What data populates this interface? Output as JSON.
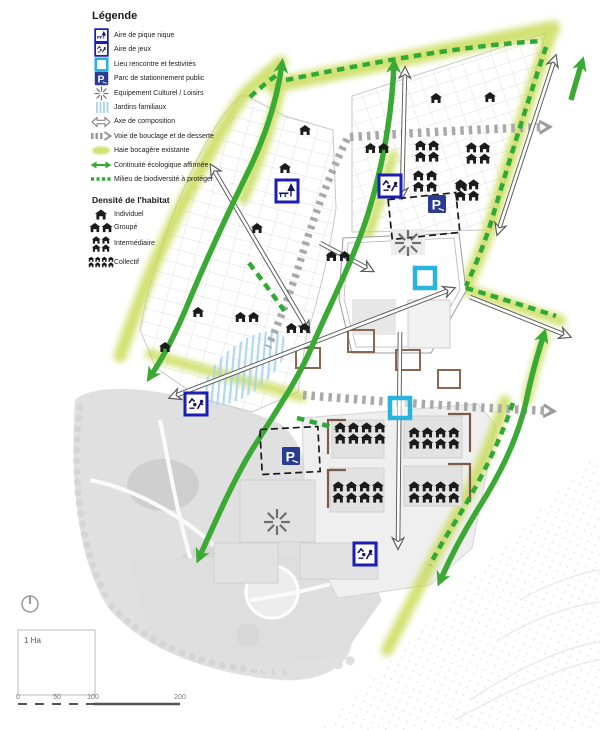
{
  "legend": {
    "title": "Légende",
    "items": [
      {
        "icon": "picnic-area-icon",
        "label": "Aire de pique nique"
      },
      {
        "icon": "playground-icon",
        "label": "Aire de jeux"
      },
      {
        "icon": "meeting-place-icon",
        "label": "Lieu rencontre et festivités"
      },
      {
        "icon": "public-parking-icon",
        "label": "Parc de stationnement public"
      },
      {
        "icon": "cultural-facility-icon",
        "label": "Equipement Culturel / Loisirs"
      },
      {
        "icon": "family-gardens-icon",
        "label": "Jardins familiaux"
      },
      {
        "icon": "composition-axis-icon",
        "label": "Axe de composition"
      },
      {
        "icon": "loop-road-icon",
        "label": "Voie de bouclage et de desserte"
      },
      {
        "icon": "existing-hedge-icon",
        "label": "Haie bocagère existante"
      },
      {
        "icon": "ecological-continuity-icon",
        "label": "Continuité écologique affirmée"
      },
      {
        "icon": "biodiversity-icon",
        "label": "Milieu de biodiversité à protéger"
      }
    ],
    "density": {
      "title": "Densité de l'habitat",
      "items": [
        {
          "icon": "house-single-icon",
          "label": "Individuel"
        },
        {
          "icon": "house-pair-icon",
          "label": "Groupé"
        },
        {
          "icon": "house-quad-icon",
          "label": "Intermédiaire"
        },
        {
          "icon": "house-octet-icon",
          "label": "Collectif"
        }
      ]
    }
  },
  "map": {
    "scale": {
      "area_label": "1 Ha",
      "ticks": [
        "0",
        "50",
        "100",
        "200"
      ]
    },
    "colors": {
      "green_corridor": "#3aaa35",
      "hedge": "#c6da4f",
      "biodiversity_dash": "#2ea836",
      "road_gray": "#a9a9a9",
      "axis_outline": "#5a5a5a",
      "meeting_cyan": "#29b4dd",
      "icon_frame_blue": "#1b1eb4",
      "parking_blue": "#2a3b92",
      "house_black": "#1b1b1b",
      "gardens_blue": "#a9d2ef",
      "park_gray": "#e0e0e0"
    },
    "markers": [
      {
        "type": "house1",
        "x": 305,
        "y": 130
      },
      {
        "type": "house1",
        "x": 285,
        "y": 168
      },
      {
        "type": "house1",
        "x": 257,
        "y": 228
      },
      {
        "type": "house1",
        "x": 198,
        "y": 312
      },
      {
        "type": "house1",
        "x": 165,
        "y": 347
      },
      {
        "type": "house1",
        "x": 436,
        "y": 98
      },
      {
        "type": "house1",
        "x": 490,
        "y": 97
      },
      {
        "type": "house1",
        "x": 462,
        "y": 186
      },
      {
        "type": "house2",
        "x": 377,
        "y": 148
      },
      {
        "type": "house2",
        "x": 338,
        "y": 256
      },
      {
        "type": "house2",
        "x": 247,
        "y": 317
      },
      {
        "type": "house2",
        "x": 298,
        "y": 328
      },
      {
        "type": "house4",
        "x": 427,
        "y": 151
      },
      {
        "type": "house4",
        "x": 478,
        "y": 153
      },
      {
        "type": "house4",
        "x": 425,
        "y": 181
      },
      {
        "type": "house4",
        "x": 467,
        "y": 190
      },
      {
        "type": "house8",
        "x": 360,
        "y": 433
      },
      {
        "type": "house8",
        "x": 434,
        "y": 438
      },
      {
        "type": "house8",
        "x": 358,
        "y": 492
      },
      {
        "type": "house8",
        "x": 434,
        "y": 492
      },
      {
        "type": "picnic",
        "x": 287,
        "y": 191
      },
      {
        "type": "jeux",
        "x": 390,
        "y": 186
      },
      {
        "type": "jeux",
        "x": 196,
        "y": 404
      },
      {
        "type": "jeux",
        "x": 365,
        "y": 554
      },
      {
        "type": "parking",
        "x": 437,
        "y": 204
      },
      {
        "type": "parking",
        "x": 291,
        "y": 456
      },
      {
        "type": "meet",
        "x": 425,
        "y": 278
      },
      {
        "type": "meet",
        "x": 400,
        "y": 408
      },
      {
        "type": "culture",
        "x": 408,
        "y": 243
      },
      {
        "type": "culture",
        "x": 277,
        "y": 522
      }
    ]
  }
}
